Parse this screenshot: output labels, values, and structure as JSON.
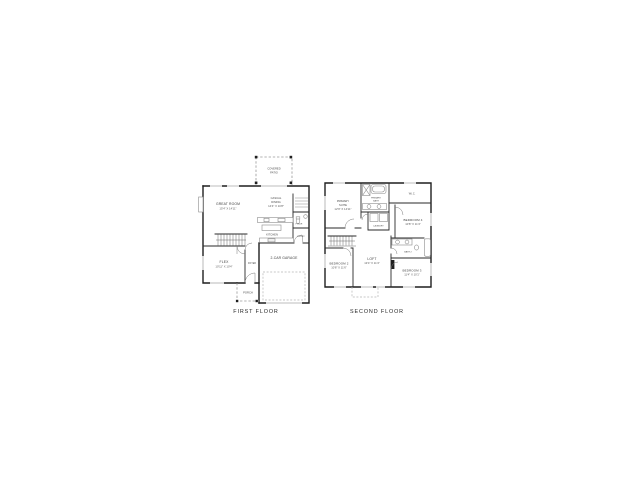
{
  "page": {
    "background": "#ffffff",
    "type": "floor-plan-sheet"
  },
  "colors": {
    "wall": "#1f1f1f",
    "fixture": "#8c8c8c",
    "dashed": "#9a9a9a",
    "text": "#3d3d3d"
  },
  "first_floor": {
    "title": "FIRST FLOOR",
    "covered_patio": {
      "line1": "COVERED",
      "line2": "PATIO"
    },
    "great_room": {
      "name": "GREAT ROOM",
      "dims": "15'4\" X 14'11\""
    },
    "casual_dining": {
      "line1": "CASUAL",
      "line2": "DINING",
      "dims": "14'4\" X 10'8\""
    },
    "kitchen": {
      "name": "KITCHEN"
    },
    "pantry": {
      "name": "PANTRY"
    },
    "powder": {
      "name": "PWDR"
    },
    "entry": {
      "name": "ENTRY"
    },
    "flex": {
      "name": "FLEX",
      "dims": "10'11\" X 10'4\""
    },
    "foyer": {
      "name": "FOYER"
    },
    "porch": {
      "name": "PORCH"
    },
    "garage": {
      "name": "2-CAR GARAGE"
    }
  },
  "second_floor": {
    "title": "SECOND FLOOR",
    "primary_suite": {
      "line1": "PRIMARY",
      "line2": "SUITE",
      "dims": "12'9\" X 14'11\""
    },
    "primary_bath": {
      "line1": "PRIMARY",
      "line2": "BATH"
    },
    "wic": {
      "name": "W.I.C."
    },
    "laundry": {
      "name": "LAUNDRY"
    },
    "bedroom4": {
      "name": "BEDROOM 4",
      "dims": "10'8\" X 11'4\""
    },
    "bath2": {
      "name": "BATH 2"
    },
    "bedroom2": {
      "name": "BEDROOM 2",
      "dims": "10'8\" X 11'6\""
    },
    "loft": {
      "name": "LOFT",
      "dims": "13'4\" X 11'4\""
    },
    "bedroom3": {
      "name": "BEDROOM 3",
      "dims": "11'4\" X 10'1\""
    }
  }
}
